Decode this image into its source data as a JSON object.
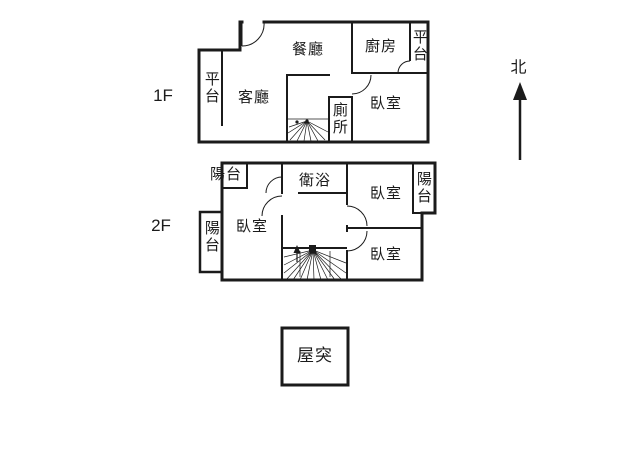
{
  "background": "#ffffff",
  "line_color": "#1b1b1b",
  "floor1": {
    "label": "1F",
    "rooms": {
      "platform_left": "平台",
      "living_room": "客廳",
      "dining_room": "餐廳",
      "kitchen": "廚房",
      "platform_right": "平台",
      "toilet": "廁所",
      "bedroom": "臥室"
    }
  },
  "floor2": {
    "label": "2F",
    "rooms": {
      "balcony_top_left": "陽台",
      "balcony_left": "陽台",
      "bedroom_left": "臥室",
      "bathroom": "衛浴",
      "bedroom_top_right": "臥室",
      "balcony_right": "陽台",
      "bedroom_bottom_right": "臥室"
    }
  },
  "roof": {
    "room": "屋突"
  },
  "compass": {
    "north_label": "北"
  }
}
